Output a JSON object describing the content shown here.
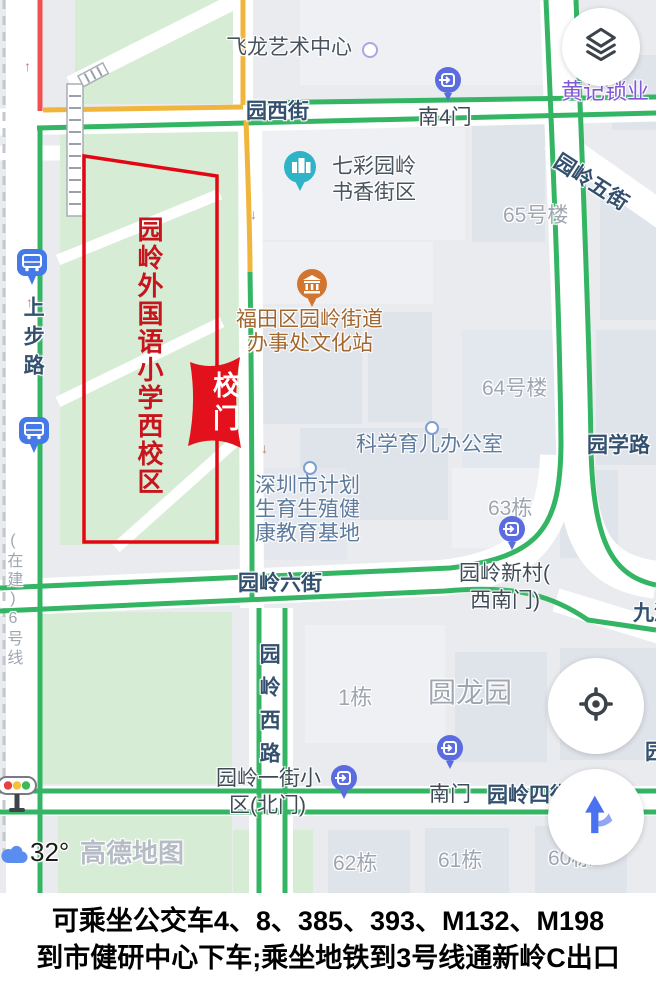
{
  "caption": {
    "line1": "可乘坐公交车4、8、385、393、M132、M198",
    "line2": "到市健研中心下车;乘坐地铁到3号线通新岭C出口"
  },
  "map": {
    "attribution": "高德地图",
    "temperature": "32°",
    "school_area": "园岭外国语小学西校区",
    "gate_banner": "校门",
    "streets": {
      "yuanxijie": "园西街",
      "wujie": "园岭五街",
      "xuelu": "园学路",
      "liujie": "园岭六街",
      "xilu": "园岭西路",
      "sijie": "园岭四街",
      "shangbulu": "上步路",
      "line6": "(在建)6号线",
      "jiuzhou": "九洲",
      "yuan_edge": "园"
    },
    "gates": {
      "nan4men": "南4门",
      "xincun_l1": "园岭新村(",
      "xincun_l2": "西南门)",
      "nanmen": "南门",
      "yijie_l1": "园岭一街小",
      "yijie_l2": "区(北门)"
    },
    "pois": {
      "feilong": "飞龙艺术中心",
      "qicai_l1": "七彩园岭",
      "qicai_l2": "书香街区",
      "huangji": "黄记锁业",
      "wenhua_l1": "福田区园岭街道",
      "wenhua_l2": "办事处文化站",
      "kexue": "科学育儿办公室",
      "jihua_l1": "深圳市计划",
      "jihua_l2": "生育生殖健",
      "jihua_l3": "康教育基地"
    },
    "buildings": {
      "b65": "65号楼",
      "b64": "64号楼",
      "b63": "63栋",
      "b1": "1栋",
      "yuanlongyuan": "圆龙园",
      "b62": "62栋",
      "b61": "61栋",
      "b60": "60栋"
    }
  },
  "colors": {
    "road_green": "#34b564",
    "road_yellow": "#f0b63c",
    "traffic_red": "#f0504f",
    "area_red": "#e30613",
    "pin_blue": "#5b6ce0",
    "bus_blue": "#4579e8",
    "teal_pin": "#2fb3c7",
    "orange_pin": "#d2752e",
    "nav_blue": "#4a71ee"
  }
}
